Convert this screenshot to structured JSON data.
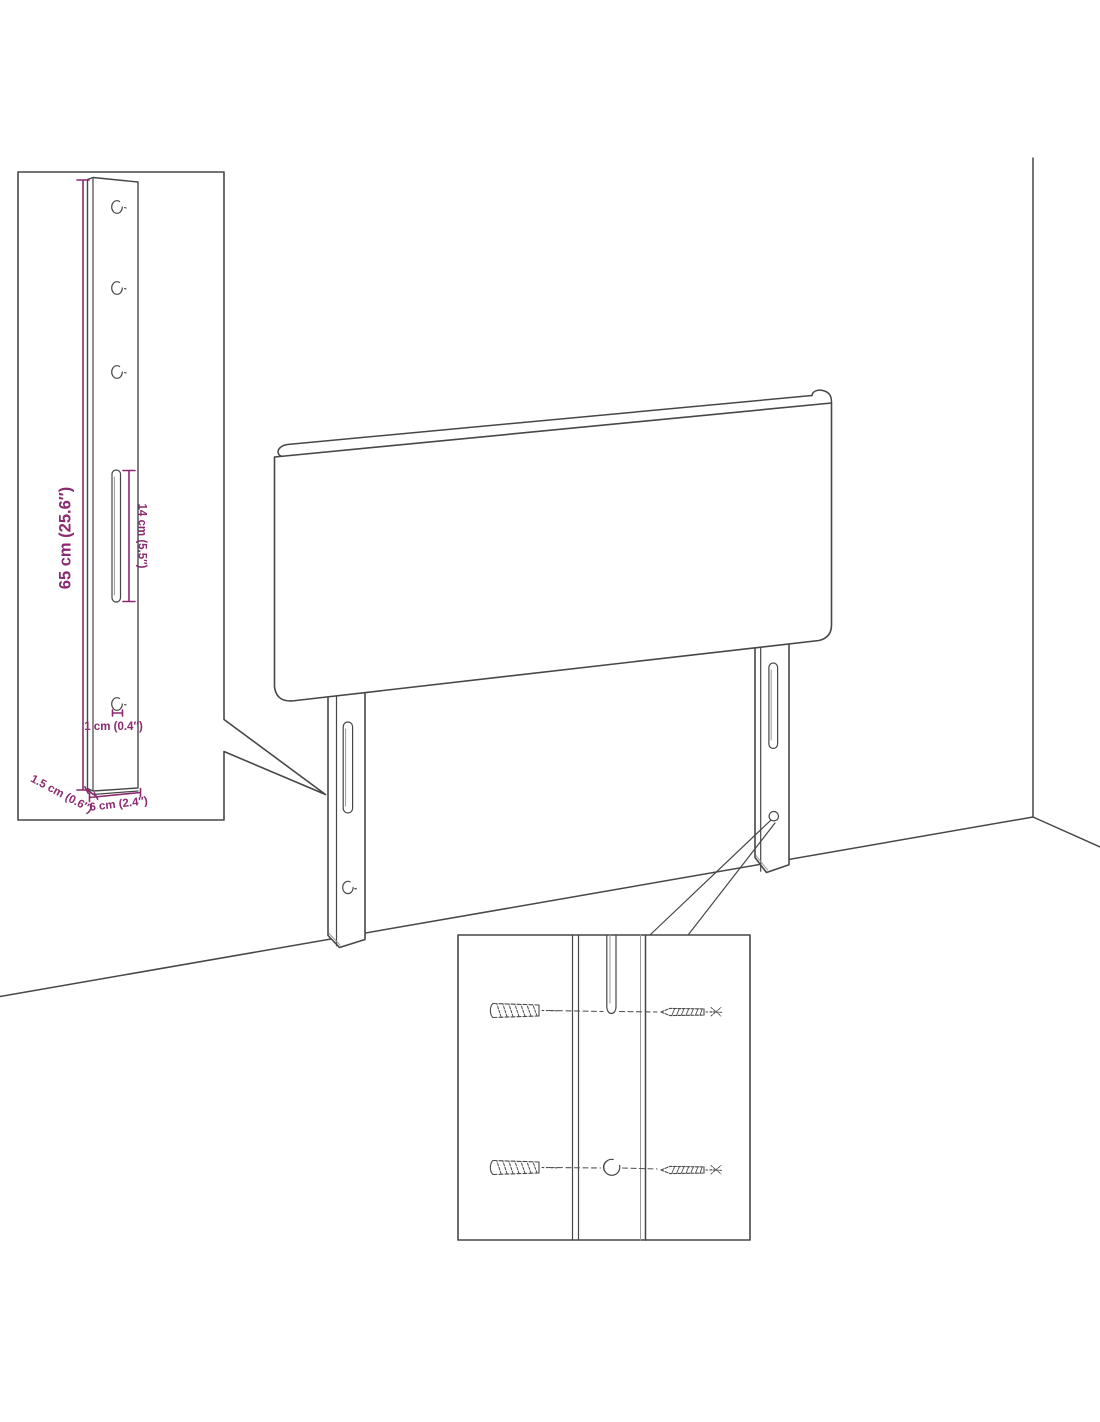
{
  "figure": {
    "title": "Headboard wall-mounting assembly diagram",
    "background": "#ffffff",
    "outline_color": "#474747",
    "dimension_color": "#8b2a70"
  },
  "dimensions": {
    "height": "65 cm (25.6″)",
    "slot_length": "14 cm (5.5″)",
    "hole_diameter": "1 cm (0.4″)",
    "depth": "1.5 cm (0.6″)",
    "width": "6 cm (2.4″)"
  }
}
